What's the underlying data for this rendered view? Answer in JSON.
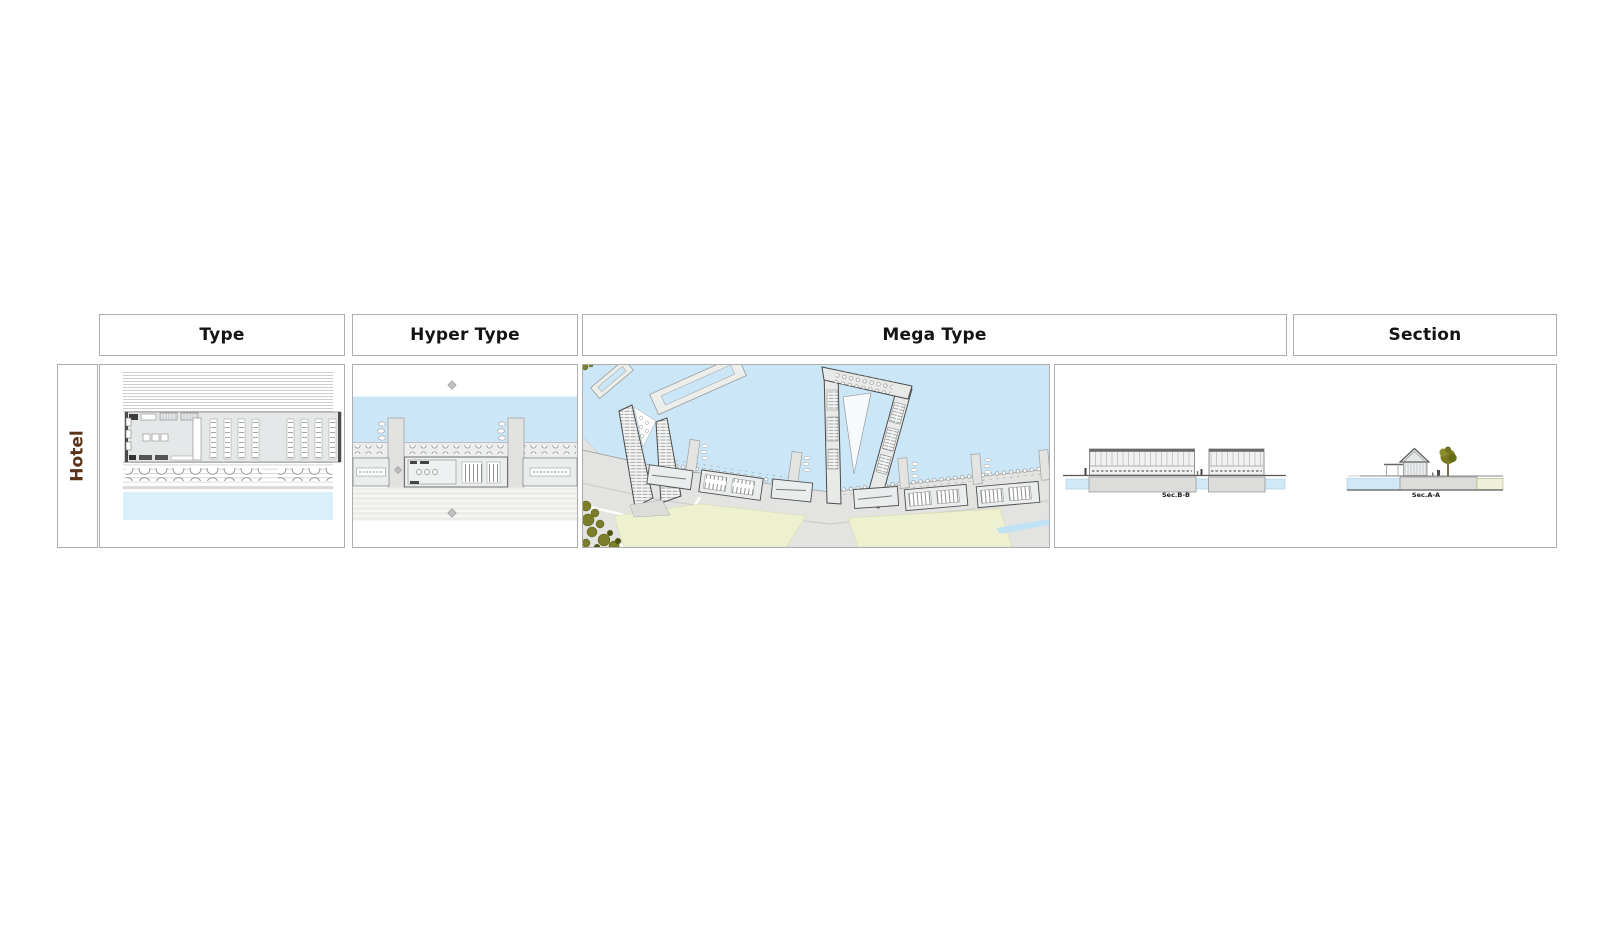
{
  "sheet": {
    "row_label": "Hotel",
    "columns": [
      {
        "id": "type",
        "label": "Type"
      },
      {
        "id": "hyper-type",
        "label": "Hyper Type"
      },
      {
        "id": "mega-type",
        "label": "Mega Type"
      },
      {
        "id": "section",
        "label": "Section"
      }
    ],
    "section_labels": {
      "bb": "Sec.B-B",
      "aa": "Sec.A-A"
    },
    "colors": {
      "row_label_text": "#5a3418",
      "header_text": "#141414",
      "grid_border": "#adadad",
      "water": "#cbe7f7",
      "water_light": "#d9f0fb",
      "ground_gray": "#e3e3e1",
      "building_fill": "#e9eded",
      "field_yellow": "#eef1cf",
      "tree_olive": "#7b7d2a"
    }
  }
}
